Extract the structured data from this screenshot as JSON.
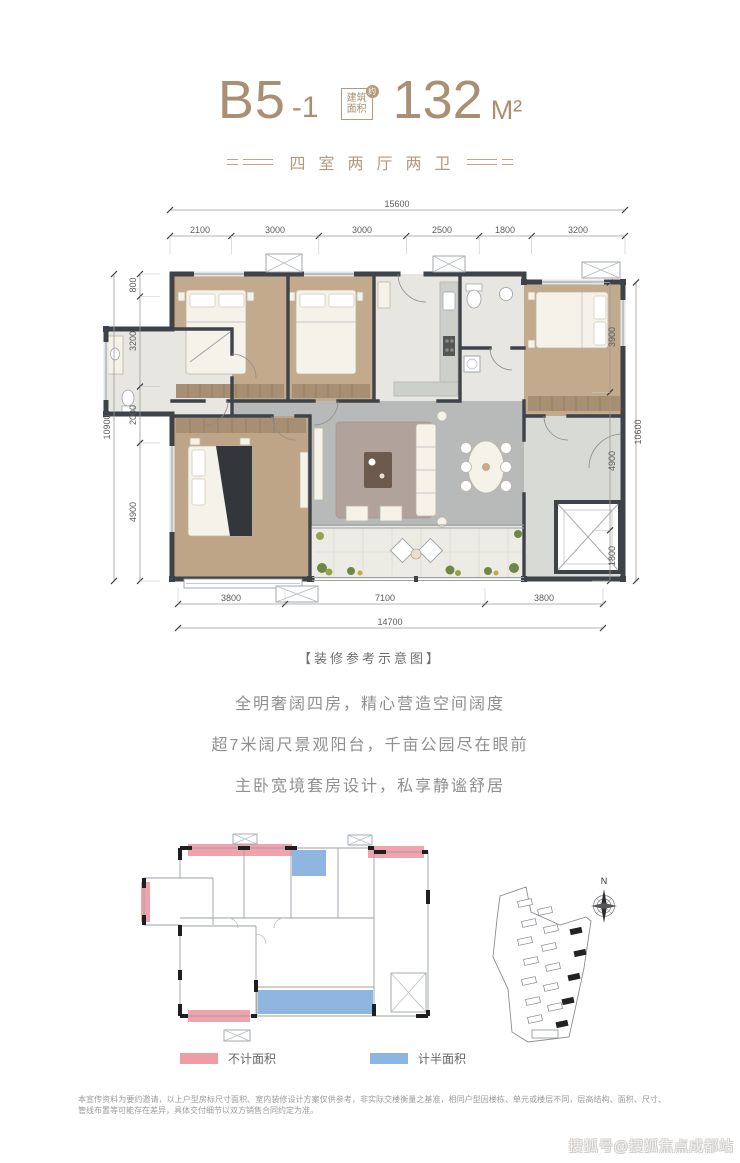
{
  "header": {
    "unit": {
      "main": "B5",
      "sub": "-1"
    },
    "area_badge": {
      "line1": "建筑",
      "line2": "面积",
      "approx": "约"
    },
    "area_value": "132",
    "area_unit": "M²",
    "subtitle": "四室两厅两卫"
  },
  "floorplan": {
    "caption": "【装修参考示意图】",
    "dims": {
      "top": {
        "total": "15600",
        "segments": [
          "2100",
          "3000",
          "3000",
          "2500",
          "1800",
          "3200"
        ]
      },
      "left": {
        "total": "10900",
        "segments": [
          "800",
          "3200",
          "2000",
          "4900"
        ]
      },
      "right": {
        "total": "10600",
        "segments": [
          "3900",
          "4900",
          "1800"
        ]
      },
      "bottom": {
        "total": "14700",
        "segments": [
          "3800",
          "7100",
          "3800"
        ]
      }
    }
  },
  "marketing": {
    "lines": [
      "全明奢阔四房，精心营造空间阔度",
      "超7米阔尺景观阳台，千亩公园尽在眼前",
      "主卧宽境套房设计，私享静谧舒居"
    ]
  },
  "diagram": {
    "legend": [
      {
        "label": "不计面积",
        "color": "#ef9da5"
      },
      {
        "label": "计半面积",
        "color": "#8db5e2"
      }
    ],
    "north_label": "N"
  },
  "disclaimer": "本宣传资料为要约邀请，以上户型房标尺寸面积、室内装修设计方案仅供参考，非实际交楼衡量之基准，相同户型因楼栋、单元或楼层不同，层高结构、面积、尺寸、管线布置等可能存在差异，具体交付细节以双方销售合同约定为准。",
  "watermark": "搜狐号@搜狐焦点成都站",
  "colors": {
    "gold": "#aa8f72",
    "pink": "#ef9da5",
    "blue": "#8db5e2"
  }
}
